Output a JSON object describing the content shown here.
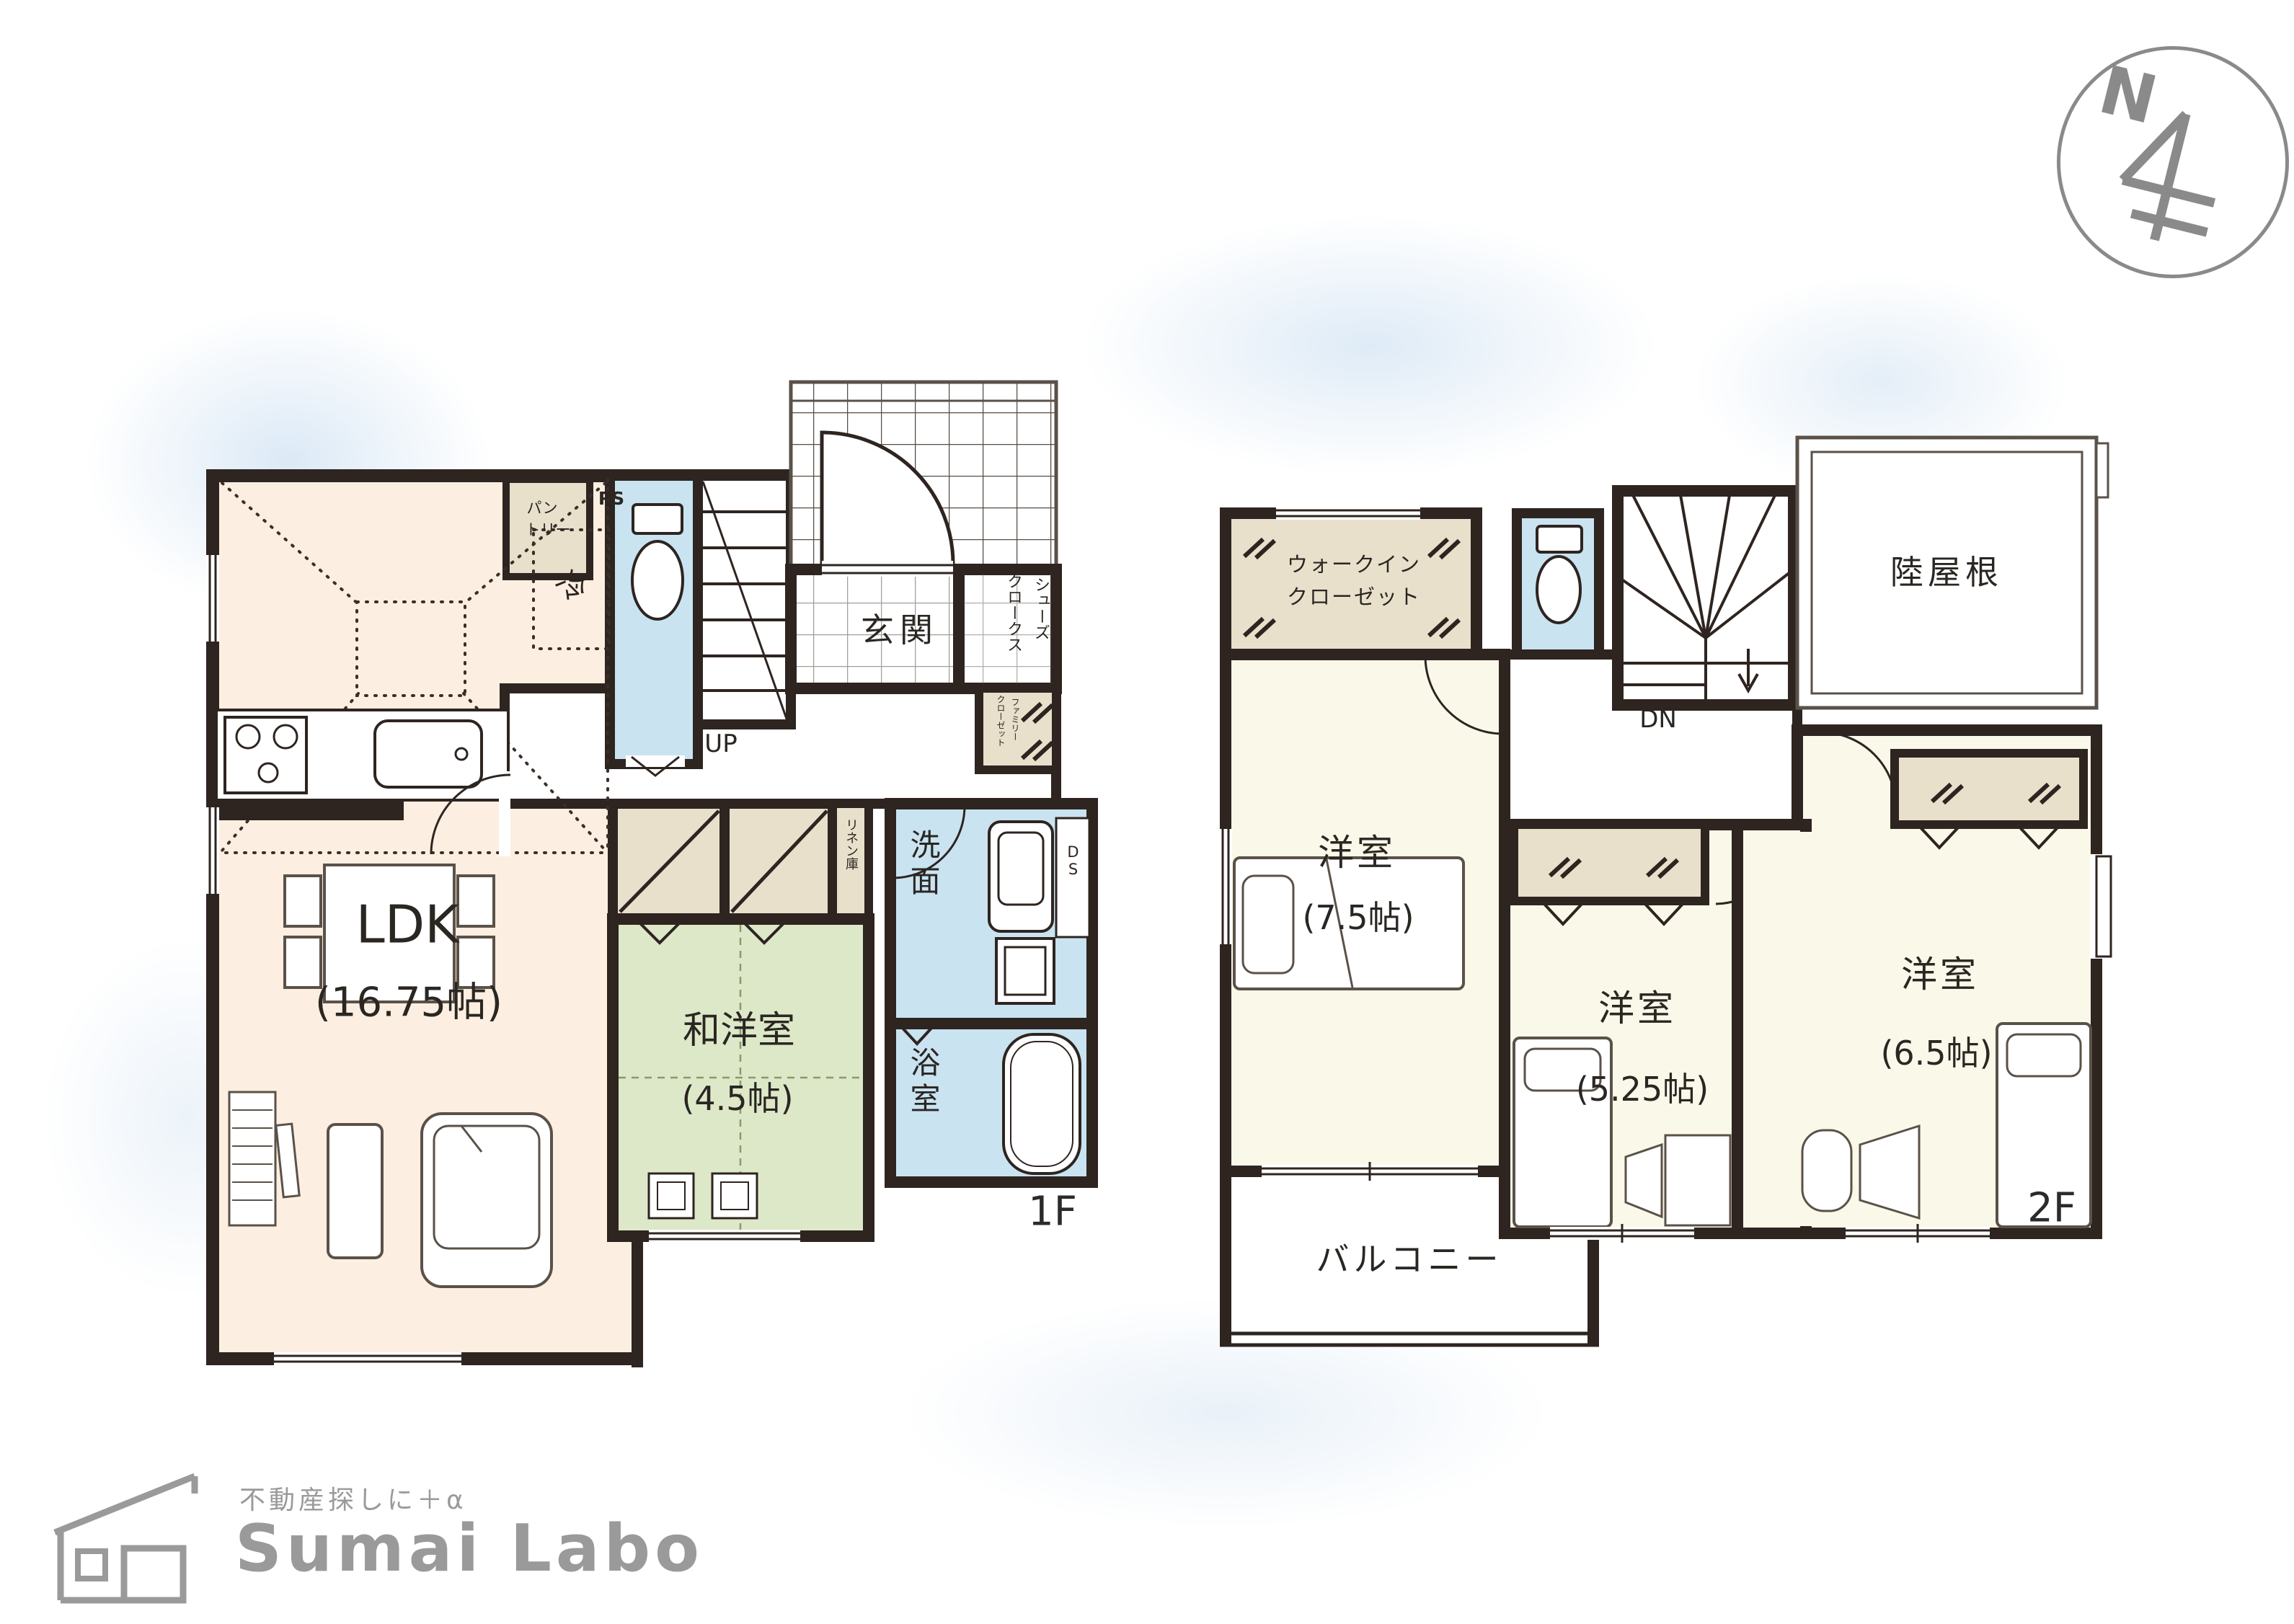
{
  "compass": {
    "north": "N"
  },
  "floor1": {
    "label": "1F",
    "ldk": {
      "name": "LDK",
      "size": "(16.75帖)"
    },
    "washitsu": {
      "name": "和洋室",
      "size": "(4.5帖)"
    },
    "genkan": "玄関",
    "shoes_closet": {
      "col1": "シューズ",
      "col2": "クロークス"
    },
    "stairs": "UP",
    "fridge": "冷",
    "pantry": {
      "line1": "パン",
      "line2": "トリー"
    },
    "ps": "PS",
    "linen": "リネン庫",
    "family_closet": {
      "col1": "ファミリー",
      "col2": "クローゼット"
    },
    "washroom": "洗面",
    "bathroom": "浴室",
    "ds": "DS"
  },
  "floor2": {
    "label": "2F",
    "wic": {
      "line1": "ウォークイン",
      "line2": "クローゼット"
    },
    "flat_roof": "陸屋根",
    "stairs": "DN",
    "bedroom1": {
      "name": "洋室",
      "size": "(7.5帖)"
    },
    "bedroom2": {
      "name": "洋室",
      "size": "(5.25帖)"
    },
    "bedroom3": {
      "name": "洋室",
      "size": "(6.5帖)"
    },
    "balcony": "バルコニー"
  },
  "logo": {
    "tagline": "不動産探しに＋α",
    "name": "Sumai Labo"
  },
  "palette": {
    "wall": "#2e2420",
    "ldk_fill": "#fcefe1",
    "tatami_fill": "#dde8c8",
    "wet_fill": "#c9e3f1",
    "closet_fill": "#e8e0cb",
    "bedroom_fill": "#faf8e9",
    "logo_gray": "#9a9a9a"
  }
}
